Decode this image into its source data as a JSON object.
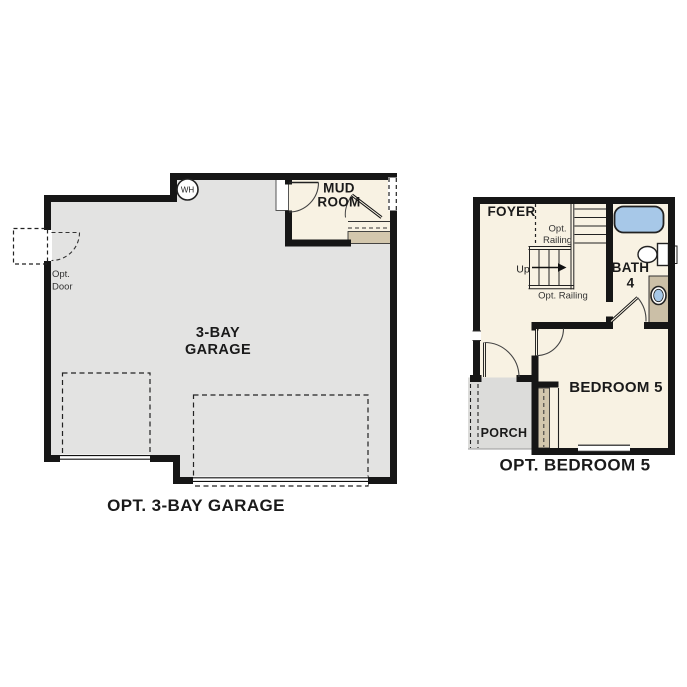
{
  "colors": {
    "wall": "#161616",
    "garage_floor": "#e3e3e2",
    "room_floor": "#f8f2e3",
    "porch_floor": "#dcdcda",
    "step_tan": "#d3c7ad",
    "vanity_tan": "#cbbfa7",
    "fixture_blue": "#a7c8e8",
    "line_dark": "#2b2b2b"
  },
  "left_plan": {
    "caption": "OPT. 3-BAY GARAGE",
    "garage_label_line1": "3-BAY",
    "garage_label_line2": "GARAGE",
    "mudroom_label_line1": "MUD",
    "mudroom_label_line2": "ROOM",
    "water_heater_label": "WH",
    "opt_door_label_line1": "Opt.",
    "opt_door_label_line2": "Door"
  },
  "right_plan": {
    "caption": "OPT. BEDROOM 5",
    "foyer_label": "FOYER",
    "bath_label_line1": "BATH",
    "bath_label_line2": "4",
    "bedroom_label": "BEDROOM 5",
    "porch_label": "PORCH",
    "up_label": "Up",
    "opt_railing_upper_line1": "Opt.",
    "opt_railing_upper_line2": "Railing",
    "opt_railing_lower": "Opt. Railing"
  }
}
